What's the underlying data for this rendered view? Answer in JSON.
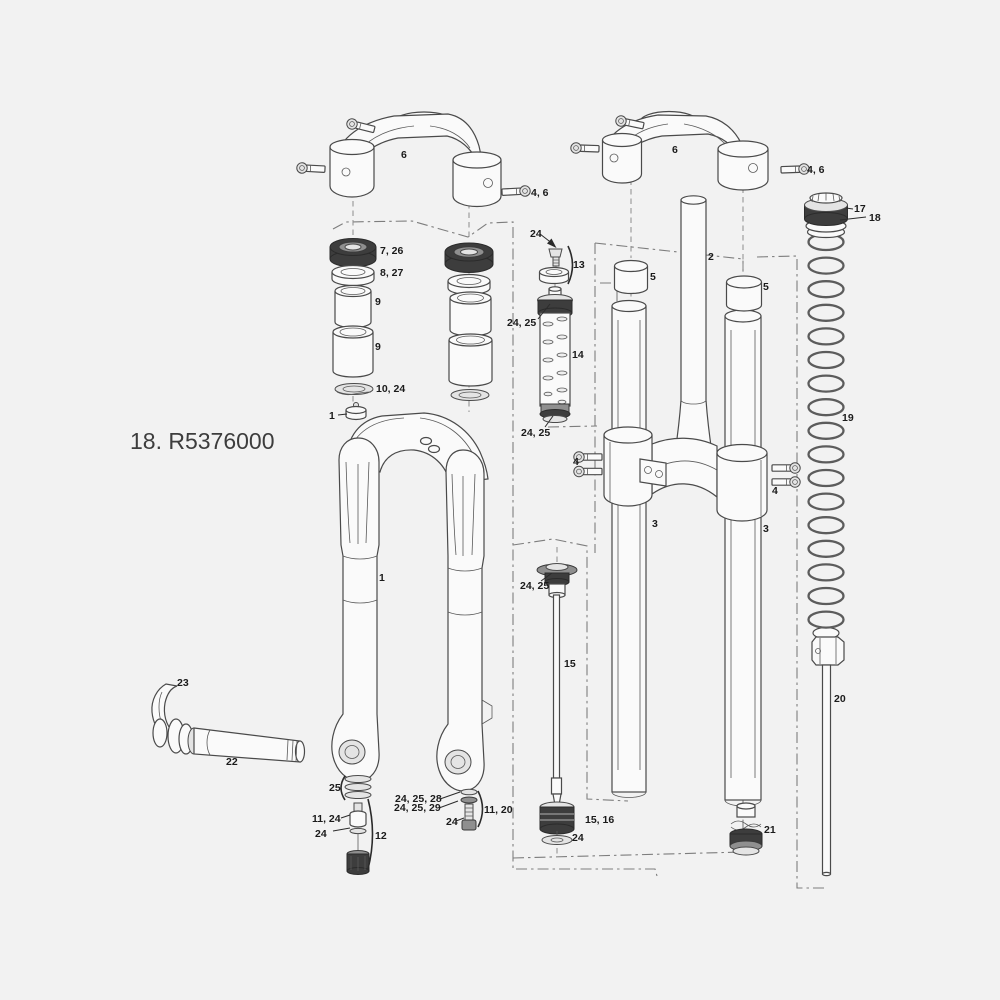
{
  "figure": {
    "code_label": "18. R5376000",
    "background": "#f2f2f2",
    "colors": {
      "line": "#4a4a4a",
      "dark_fill": "#3d3d3d",
      "label_text": "#1b1b1b",
      "boundary_line": "#7d7d7d"
    }
  },
  "labels": [
    {
      "part": "crown-left",
      "text": "6"
    },
    {
      "part": "crown-left-bolt",
      "text": "4, 6"
    },
    {
      "part": "crown-right",
      "text": "6"
    },
    {
      "part": "crown-right-bolt",
      "text": "4, 6"
    },
    {
      "part": "spring-top-cap",
      "text": "17"
    },
    {
      "part": "spring-top-cap-rings",
      "text": "18"
    },
    {
      "part": "dust-seal",
      "text": "7, 26"
    },
    {
      "part": "foam-ring",
      "text": "8, 27"
    },
    {
      "part": "bushing-upper",
      "text": "9"
    },
    {
      "part": "bushing-lower",
      "text": "9"
    },
    {
      "part": "crush-washer",
      "text": "10, 24"
    },
    {
      "part": "lower-leg-bumper",
      "text": "1"
    },
    {
      "part": "damper-bolt",
      "text": "24"
    },
    {
      "part": "damper-clamp-ring",
      "text": "13"
    },
    {
      "part": "damper-top-seal",
      "text": "24, 25"
    },
    {
      "part": "damper-body",
      "text": "14"
    },
    {
      "part": "damper-bottom-seal",
      "text": "24, 25"
    },
    {
      "part": "steerer-tube",
      "text": "2"
    },
    {
      "part": "spacer-left",
      "text": "5"
    },
    {
      "part": "spacer-right",
      "text": "5"
    },
    {
      "part": "coil-spring",
      "text": "19"
    },
    {
      "part": "crown-bolts-left",
      "text": "4"
    },
    {
      "part": "crown-bolts-right",
      "text": "4"
    },
    {
      "part": "stanchion-left",
      "text": "3"
    },
    {
      "part": "stanchion-right",
      "text": "3"
    },
    {
      "part": "air-shaft-seal",
      "text": "24, 25"
    },
    {
      "part": "air-shaft",
      "text": "15"
    },
    {
      "part": "lower-legs",
      "text": "1"
    },
    {
      "part": "axle-lever",
      "text": "23"
    },
    {
      "part": "thru-axle",
      "text": "22"
    },
    {
      "part": "washer-stack",
      "text": "25"
    },
    {
      "part": "rebound-adjuster",
      "text": "11, 24"
    },
    {
      "part": "rebound-washer",
      "text": "24"
    },
    {
      "part": "rebound-assembly",
      "text": "12"
    },
    {
      "part": "footnut-washer-a",
      "text": "24, 25, 28"
    },
    {
      "part": "footnut-washer-b",
      "text": "24, 25, 29"
    },
    {
      "part": "foot-bolt",
      "text": "24"
    },
    {
      "part": "foot-bolt-assembly",
      "text": "11, 20"
    },
    {
      "part": "air-piston",
      "text": "15, 16"
    },
    {
      "part": "air-piston-washer",
      "text": "24"
    },
    {
      "part": "spring-seal-head",
      "text": "21"
    },
    {
      "part": "spring-shaft",
      "text": "20"
    }
  ]
}
